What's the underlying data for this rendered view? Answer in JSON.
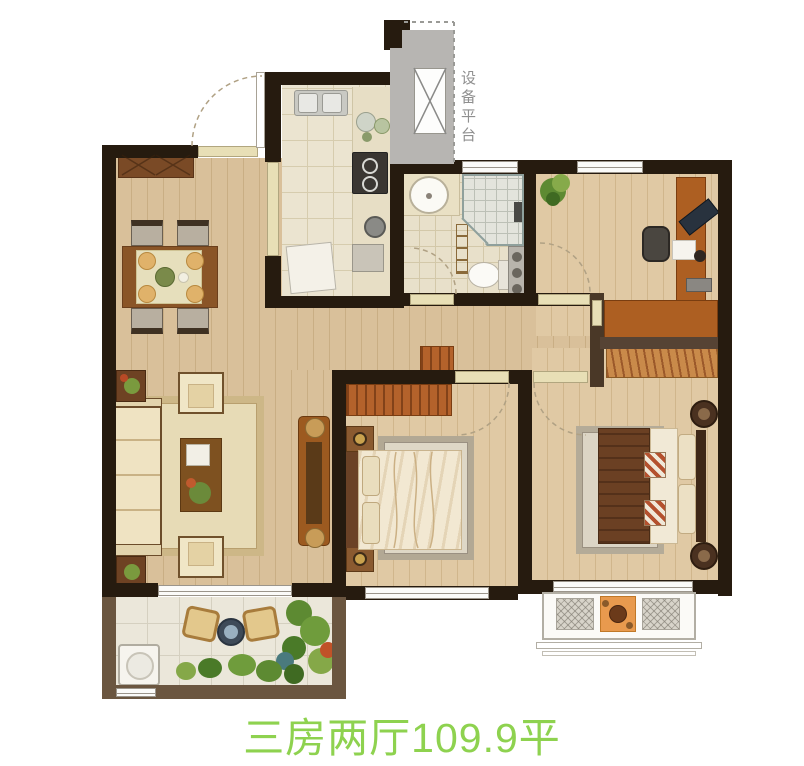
{
  "caption": {
    "text": "三房两厅109.9平"
  },
  "platform": {
    "label": "设备平台"
  },
  "palette": {
    "caption_green": "#8ed24f",
    "label_gray": "#8f8f8f",
    "wall_dark": "#261b0f",
    "wall_brown": "#6b5640",
    "wood_floor": "#d9c09a",
    "tile_beige": "#ebe4d0",
    "wardrobe_orange": "#b4622b",
    "threshold_beige": "#e8dfb6"
  }
}
